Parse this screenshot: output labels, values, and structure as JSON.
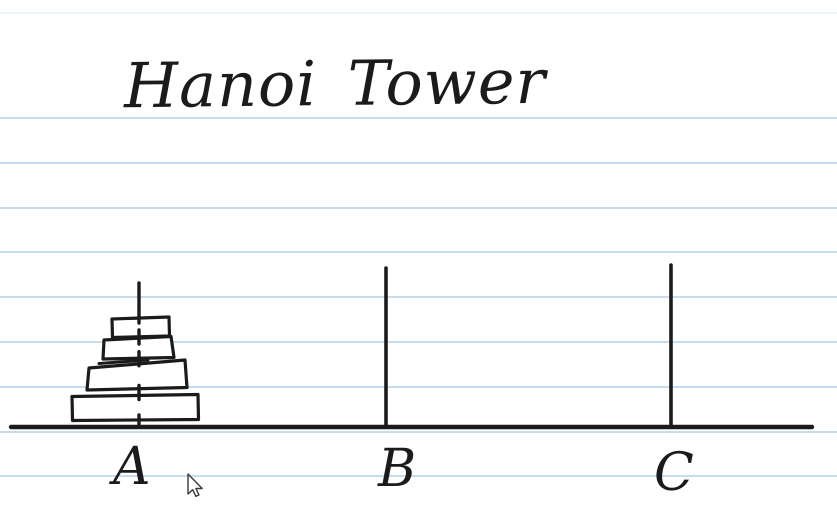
{
  "canvas": {
    "title": "Hanoi Tower",
    "colors": {
      "background": "#ffffff",
      "ink": "#1b1b1b",
      "ruled_line": "#b5d1ec",
      "ruled_line_faint": "#e3edf8",
      "disk_fill": "#ffffff",
      "cursor_fill": "#ffffff",
      "cursor_outline": "#3a3a3a"
    },
    "ruled_lines": {
      "faint_top_y": 13,
      "ys": [
        118,
        163,
        208,
        252,
        297,
        342,
        387,
        432,
        476
      ]
    },
    "baseline": {
      "x1": 11,
      "x2": 812,
      "y": 427
    },
    "pegs": [
      {
        "label": "A",
        "x": 139,
        "top": 283,
        "disk_count": 4,
        "label_x": 113,
        "label_y": 441
      },
      {
        "label": "B",
        "x": 386,
        "top": 268,
        "disk_count": 0,
        "label_x": 378,
        "label_y": 443
      },
      {
        "label": "C",
        "x": 671,
        "top": 265,
        "disk_count": 0,
        "label_x": 654,
        "label_y": 447
      }
    ],
    "disks": [
      {
        "peg": "A",
        "size": 1,
        "x": 112,
        "y": 317,
        "width": 57,
        "height": 20
      },
      {
        "peg": "A",
        "size": 2,
        "x": 103,
        "y": 337,
        "width": 70,
        "height": 21.5
      },
      {
        "peg": "A",
        "size": 3,
        "x": 87,
        "y": 359,
        "width": 100,
        "height": 31
      },
      {
        "peg": "A",
        "size": 4,
        "x": 72,
        "y": 395,
        "width": 126,
        "height": 25
      }
    ],
    "cursor": {
      "x": 188,
      "y": 474
    }
  }
}
